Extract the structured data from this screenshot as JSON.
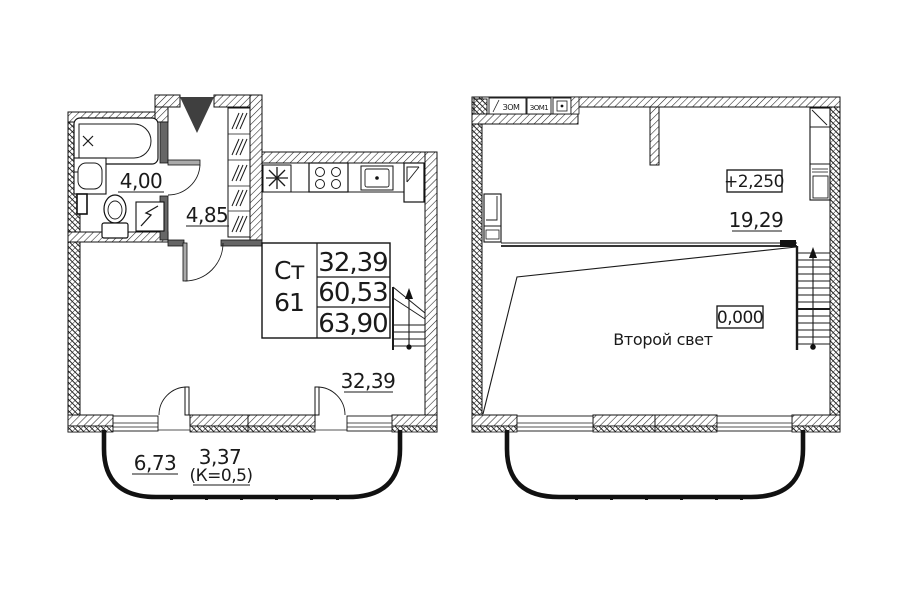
{
  "colors": {
    "line": "#1a1a1a",
    "partition_fill": "#666666",
    "entry_arrow": "#3f3f3f",
    "background": "#ffffff"
  },
  "left_plan": {
    "bathroom_area": "4,00",
    "hall_area": "4,85",
    "unit_table": {
      "type_label": "Ст",
      "unit_number": "61",
      "area_living": "32,39",
      "area_total": "60,53",
      "area_with_balcony": "63,90"
    },
    "room_area": "32,39",
    "balcony_area_full": "6,73",
    "balcony_area_reduced": "3,37",
    "balcony_coefficient": "(К=0,5)"
  },
  "right_plan": {
    "elevation_upper": "+2,250",
    "mezzanine_area": "19,29",
    "elevation_lower": "0,000",
    "double_height_label": "Второй свет",
    "closet_labels": [
      "ЗОМ",
      "ЗОМ1"
    ]
  }
}
